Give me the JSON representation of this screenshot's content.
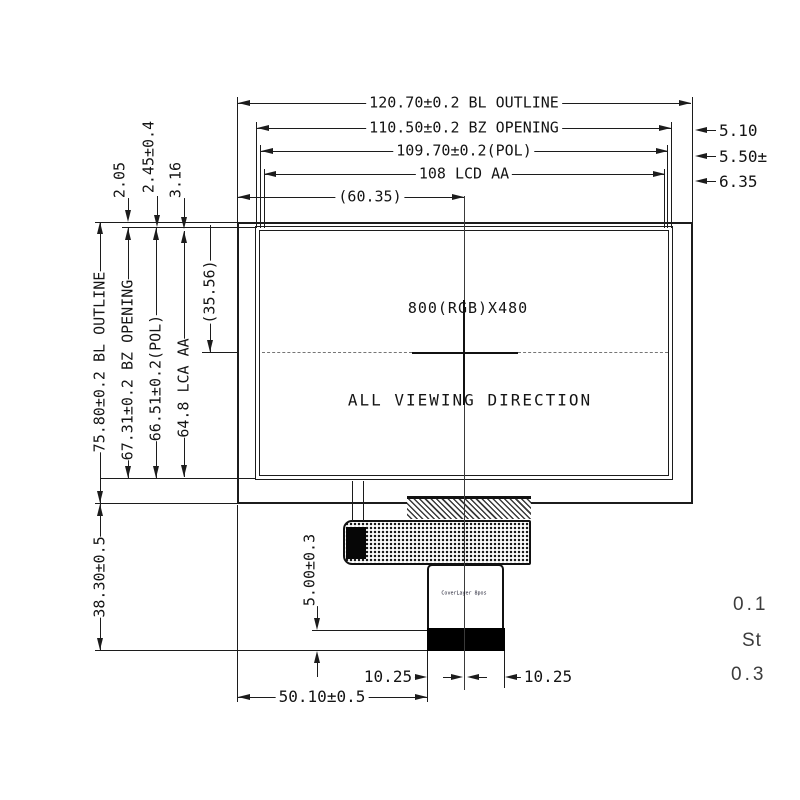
{
  "meta": {
    "drawing_type": "LCD module mechanical outline drawing",
    "ink_color": "#1c1c1c",
    "background_color": "#ffffff"
  },
  "dims": {
    "bl_outline_w": "120.70±0.2 BL OUTLINE",
    "bz_opening_w": "110.50±0.2 BZ OPENING",
    "pol_w": "109.70±0.2(POL)",
    "lcd_aa_w": "108 LCD AA",
    "half_w": "(60.35)",
    "r1": "5.10",
    "r2": "5.50±",
    "r3": "6.35",
    "t1": "2.05",
    "t2": "2.45±0.4",
    "t3": "3.16",
    "bl_outline_h": "75.80±0.2 BL OUTLINE",
    "bz_opening_h": "67.31±0.2 BZ OPENING",
    "pol_h": "66.51±0.2(POL)",
    "lca_aa_h": "64.8 LCA AA",
    "half_h": "(35.56)",
    "b_total": "38.30±0.5",
    "b_conn": "5.00±0.3",
    "b_1025_l": "10.25",
    "b_1025_r": "10.25",
    "b_5010": "50.10±0.5"
  },
  "panel": {
    "resolution": "800(RGB)X480",
    "viewing_direction": "ALL VIEWING DIRECTION"
  },
  "fpc": {
    "tab_marking": "CoverLayer 8pos"
  },
  "clipped_notes": {
    "n1": "0.1",
    "n2": "St",
    "n3": "0.3"
  }
}
